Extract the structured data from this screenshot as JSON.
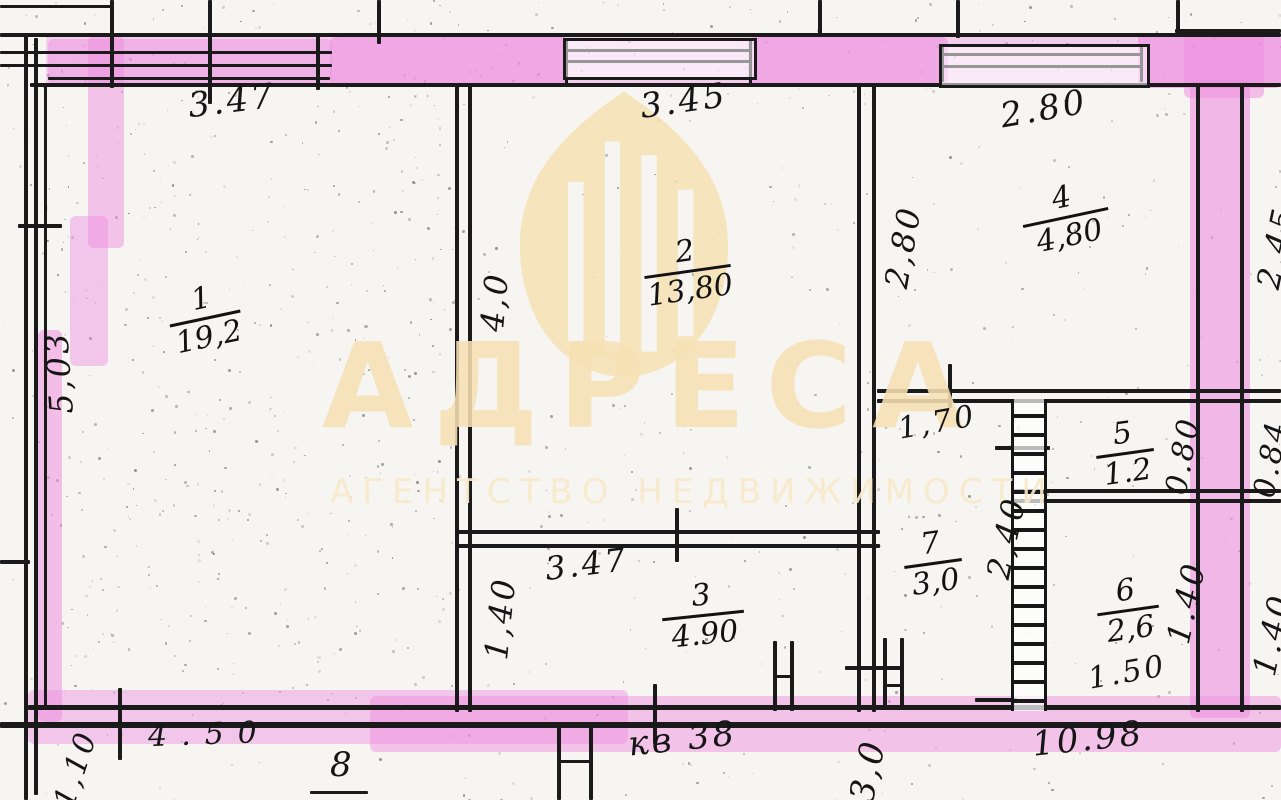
{
  "watermark": {
    "brand": "АДРЕСА",
    "tagline": "АГЕНТСТВО НЕДВИЖИМОСТИ"
  },
  "colors": {
    "highlight": "#ee8fe0",
    "ink": "#1a1a1a",
    "paper": "#f6f5f2",
    "watermark_beige": "#f6e0b4"
  },
  "rooms": [
    {
      "number": "1",
      "area": "19,2"
    },
    {
      "number": "2",
      "area": "13,80"
    },
    {
      "number": "3",
      "area": "4.90"
    },
    {
      "number": "4",
      "area": "4,80"
    },
    {
      "number": "5",
      "area": "1.2"
    },
    {
      "number": "6",
      "area": "2,6"
    },
    {
      "number": "7",
      "area": "3,0"
    }
  ],
  "dims": {
    "room1_top": "3.47",
    "room1_left": "5,03",
    "room2_top": "3.45",
    "room2_left": "4,0",
    "room4_top": "2.80",
    "room4_left": "2,80",
    "right_top": "2.45",
    "corridor_top": "1,70",
    "room7_right": "2,40",
    "room5_right": "0.80",
    "right_mid": "0.84",
    "room6_right": "1.40",
    "right_bottom": "1.40",
    "room6_bottom": "1.50",
    "room3_top": "3.47",
    "room3_left": "1,40",
    "bottom_left": "4.50",
    "bottom_right": "10.98",
    "bottom_left_vertical": "1,10",
    "bottom_partial_vertical": "3,0",
    "apartment_label": "кв 38",
    "house_label": "8"
  }
}
